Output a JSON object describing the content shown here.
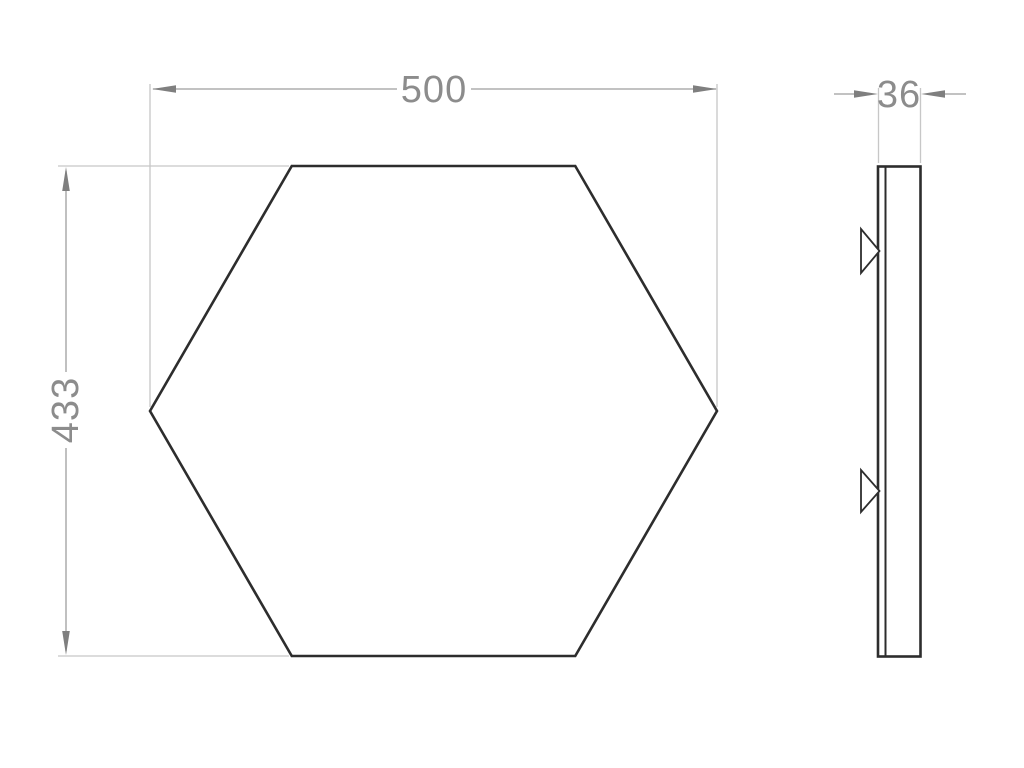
{
  "front_view": {
    "shape": "hexagon",
    "width_dimension": "500",
    "height_dimension": "433"
  },
  "side_view": {
    "thickness_dimension": "36",
    "clip_count": 2
  },
  "colors": {
    "background": "#ffffff",
    "drawing_stroke": "#2d2d2d",
    "dimension_line": "#9e9e9e",
    "extension_line": "#c7c7c7",
    "dimension_arrow": "#7f7f7f",
    "dimension_text": "#8c8c8c"
  }
}
